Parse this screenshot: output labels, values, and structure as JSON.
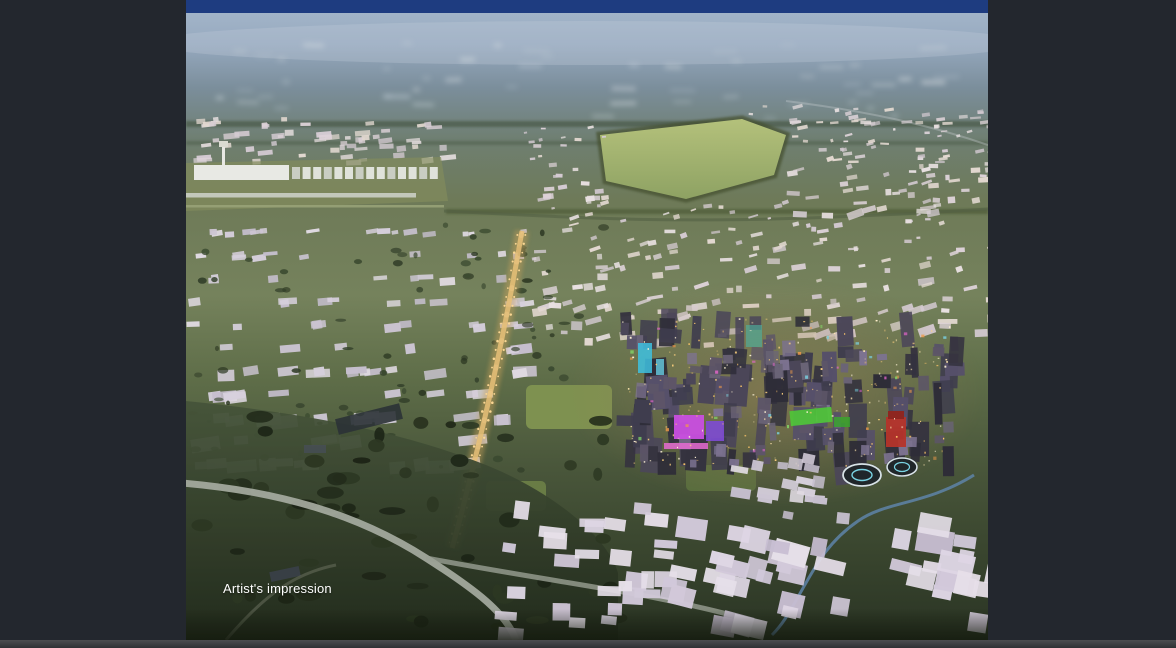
{
  "header": {
    "bar_label": ""
  },
  "hero": {
    "caption": "Artist's impression"
  },
  "colors": {
    "page_bg": "#23272e",
    "header_bar": "#1e3c80",
    "caption_text": "#ffffff",
    "bottom_strip_top": "#4c4d50",
    "bottom_strip_bottom": "#2e3134",
    "sky_haze": "#a2b4c8",
    "distant_blue": "#7b8e9b",
    "land_olive": "#6e7a58",
    "land_green": "#5f6e49",
    "foreground_dark": "#2a3424",
    "building_light": "#ded6e4",
    "building_mid": "#cdc6d4",
    "warehouse_white": "#e7dfe0",
    "city_dark": "#3f3d4e",
    "light_amber": "#e8c078",
    "accent_magenta": "#c94fe0",
    "accent_purple": "#7e4bd4",
    "accent_green": "#4fc838",
    "accent_red": "#b5342a",
    "accent_cyan": "#3ec1e0",
    "road_light": "#a9aea3",
    "creek_blue": "#5e84a8",
    "field_green": "#a8b873",
    "park_green": "#7e9150",
    "tree_dark": "#2c3722"
  }
}
